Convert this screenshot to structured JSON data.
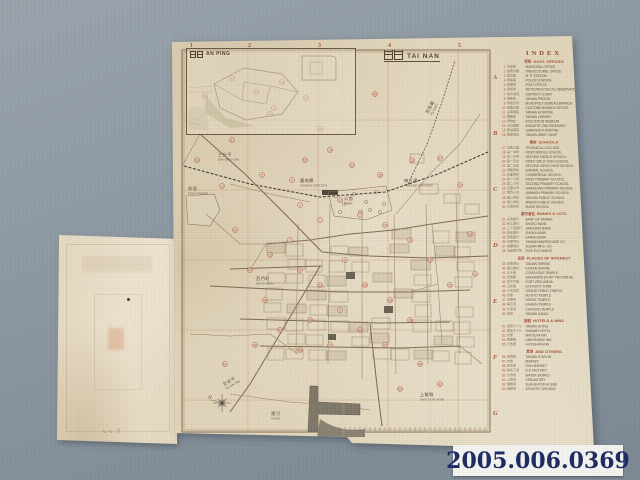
{
  "photo": {
    "backdrop_color": "#8c97a1",
    "paper_color": "#e7dcc4",
    "accent_red": "#b04f38",
    "ink_brown": "#5d4e3c",
    "label_navy": "#1d2a63"
  },
  "catalog": {
    "id": "2005.006.0369"
  },
  "flap": {
    "pencil_mark": "∿∿ 8"
  },
  "map": {
    "title_jp": "臺南",
    "title_en": "TAI NAN",
    "inset_jp": "安平",
    "inset_en": "AN PING",
    "compass": "N",
    "grid_cols": [
      "1",
      "2",
      "3",
      "4",
      "5"
    ],
    "grid_col_x": [
      20,
      78,
      148,
      218,
      288
    ],
    "grid_rows": [
      "A",
      "B",
      "C",
      "D",
      "E",
      "F",
      "G"
    ],
    "grid_row_y": [
      45,
      101,
      157,
      213,
      269,
      325,
      381
    ],
    "labels": [
      {
        "jp": "魚塭",
        "en": "FISH PONDS",
        "x": 18,
        "y": 156,
        "rot": 0
      },
      {
        "jp": "三分子",
        "en": "SAN BUN SHI",
        "x": 48,
        "y": 122,
        "rot": 0
      },
      {
        "jp": "臺南驛",
        "en": "TAINAN STATION",
        "x": 130,
        "y": 148,
        "rot": 0
      },
      {
        "jp": "公園",
        "en": "PARK",
        "x": 174,
        "y": 166,
        "rot": 0
      },
      {
        "jp": "練兵場",
        "en": "PARADE GROUND",
        "x": 234,
        "y": 148,
        "rot": 0
      },
      {
        "jp": "至嘉義",
        "en": "TO KAGI",
        "x": 258,
        "y": 80,
        "rot": -62
      },
      {
        "jp": "西門町",
        "en": "NISHI MON",
        "x": 86,
        "y": 246,
        "rot": 0
      },
      {
        "jp": "至安平",
        "en": "TO AN PEI",
        "x": 54,
        "y": 352,
        "rot": -30
      },
      {
        "jp": "運河",
        "en": "UNGA",
        "x": 101,
        "y": 381,
        "rot": 0
      },
      {
        "jp": "上鯤鯓",
        "en": "SHO KON SHIN",
        "x": 250,
        "y": 362,
        "rot": 0
      }
    ],
    "markers": [
      {
        "x": 62,
        "y": 44,
        "n": 43
      },
      {
        "x": 86,
        "y": 58,
        "n": 44
      },
      {
        "x": 112,
        "y": 48,
        "n": 45
      },
      {
        "x": 104,
        "y": 74,
        "n": 10
      },
      {
        "x": 136,
        "y": 64,
        "n": 52
      },
      {
        "x": 35,
        "y": 62,
        "n": 56
      },
      {
        "x": 62,
        "y": 106,
        "n": 31
      },
      {
        "x": 27,
        "y": 126,
        "n": 50
      },
      {
        "x": 52,
        "y": 152,
        "n": 12
      },
      {
        "x": 92,
        "y": 141,
        "n": 5
      },
      {
        "x": 122,
        "y": 146,
        "n": 3
      },
      {
        "x": 135,
        "y": 126,
        "n": 57
      },
      {
        "x": 160,
        "y": 116,
        "n": 14
      },
      {
        "x": 182,
        "y": 131,
        "n": 22
      },
      {
        "x": 210,
        "y": 141,
        "n": 18
      },
      {
        "x": 242,
        "y": 126,
        "n": 16
      },
      {
        "x": 270,
        "y": 124,
        "n": 37
      },
      {
        "x": 290,
        "y": 151,
        "n": 17
      },
      {
        "x": 130,
        "y": 171,
        "n": 4
      },
      {
        "x": 150,
        "y": 186,
        "n": 1
      },
      {
        "x": 170,
        "y": 166,
        "n": 13
      },
      {
        "x": 190,
        "y": 181,
        "n": 2
      },
      {
        "x": 215,
        "y": 191,
        "n": 24
      },
      {
        "x": 240,
        "y": 206,
        "n": 19
      },
      {
        "x": 260,
        "y": 226,
        "n": 25
      },
      {
        "x": 280,
        "y": 251,
        "n": 29
      },
      {
        "x": 120,
        "y": 206,
        "n": 7
      },
      {
        "x": 100,
        "y": 221,
        "n": 33
      },
      {
        "x": 80,
        "y": 236,
        "n": 41
      },
      {
        "x": 130,
        "y": 236,
        "n": 8
      },
      {
        "x": 150,
        "y": 251,
        "n": 32
      },
      {
        "x": 175,
        "y": 226,
        "n": 6
      },
      {
        "x": 195,
        "y": 251,
        "n": 34
      },
      {
        "x": 220,
        "y": 266,
        "n": 26
      },
      {
        "x": 170,
        "y": 276,
        "n": 9
      },
      {
        "x": 140,
        "y": 286,
        "n": 35
      },
      {
        "x": 110,
        "y": 296,
        "n": 42
      },
      {
        "x": 85,
        "y": 311,
        "n": 46
      },
      {
        "x": 130,
        "y": 316,
        "n": 58
      },
      {
        "x": 160,
        "y": 311,
        "n": 27
      },
      {
        "x": 190,
        "y": 296,
        "n": 38
      },
      {
        "x": 215,
        "y": 311,
        "n": 47
      },
      {
        "x": 240,
        "y": 286,
        "n": 28
      },
      {
        "x": 95,
        "y": 266,
        "n": 40
      },
      {
        "x": 65,
        "y": 196,
        "n": 51
      },
      {
        "x": 205,
        "y": 60,
        "n": 55
      },
      {
        "x": 150,
        "y": 95,
        "n": 23
      },
      {
        "x": 100,
        "y": 80,
        "n": 30
      },
      {
        "x": 250,
        "y": 330,
        "n": 48
      },
      {
        "x": 270,
        "y": 350,
        "n": 62
      },
      {
        "x": 300,
        "y": 200,
        "n": 20
      },
      {
        "x": 305,
        "y": 240,
        "n": 21
      },
      {
        "x": 55,
        "y": 330,
        "n": 61
      },
      {
        "x": 230,
        "y": 355,
        "n": 59
      }
    ]
  },
  "index": {
    "title": "INDEX",
    "sections": [
      {
        "jp": "官衙",
        "en": "GOVT. OFFICES",
        "rows": [
          {
            "n": 1,
            "jp": "市役所",
            "en": "MUNICIPAL OFFICE"
          },
          {
            "n": 2,
            "jp": "臺南州廳",
            "en": "PREFECTURAL OFFICE"
          },
          {
            "n": 3,
            "jp": "憲兵隊",
            "en": "M. P. STATION"
          },
          {
            "n": 4,
            "jp": "警察署",
            "en": "POLICE STATION"
          },
          {
            "n": 5,
            "jp": "郵便局",
            "en": "POST OFFICE"
          },
          {
            "n": 6,
            "jp": "測候所",
            "en": "METEOROLOGICAL OBSERVATORY"
          },
          {
            "n": 7,
            "jp": "地方法院",
            "en": "DISTRICT COURT"
          },
          {
            "n": 8,
            "jp": "刑務所",
            "en": "TAINAN PRISON"
          },
          {
            "n": 9,
            "jp": "專賣支局",
            "en": "MONOPOLY BUREAU BRANCH"
          },
          {
            "n": 10,
            "jp": "稅關支署",
            "en": "CUSTOMS BRANCH OFFICE"
          },
          {
            "n": 11,
            "jp": "臺南醫院",
            "en": "TAINAN HOSPITAL"
          },
          {
            "n": 12,
            "jp": "圖書館",
            "en": "TAINAN LIBRARY"
          },
          {
            "n": 13,
            "jp": "博物館",
            "en": "EDUCATION MUSEUM"
          },
          {
            "n": 14,
            "jp": "步兵聯隊",
            "en": "INFANTRY 2ND REGIMENT"
          },
          {
            "n": 15,
            "jp": "衛戍病院",
            "en": "GARRISON HOSPITAL"
          },
          {
            "n": 16,
            "jp": "陸軍墓地",
            "en": "TAINAN ARMY CAMP"
          }
        ]
      },
      {
        "jp": "學校",
        "en": "SCHOOLS",
        "rows": [
          {
            "n": 17,
            "jp": "高等工業",
            "en": "TECHNICAL COLLEGE"
          },
          {
            "n": 18,
            "jp": "第一中學",
            "en": "FIRST MIDDLE SCHOOL"
          },
          {
            "n": 19,
            "jp": "第二中學",
            "en": "SECOND MIDDLE SCHOOL"
          },
          {
            "n": 20,
            "jp": "第一高女",
            "en": "FIRST GIRLS' HIGH SCHOOL"
          },
          {
            "n": 21,
            "jp": "第二高女",
            "en": "SECOND GIRLS' HIGH SCHOOL"
          },
          {
            "n": 22,
            "jp": "師範學校",
            "en": "NORMAL SCHOOL"
          },
          {
            "n": 23,
            "jp": "商業學校",
            "en": "COMMERCIAL SCHOOL"
          },
          {
            "n": 24,
            "jp": "第一小學",
            "en": "FIRST PRIMARY SCHOOL"
          },
          {
            "n": 25,
            "jp": "第二小學",
            "en": "SECOND PRIMARY SCHOOL"
          },
          {
            "n": 26,
            "jp": "花園小學",
            "en": "HANAZONO PRIMARY SCHOOL"
          },
          {
            "n": 27,
            "jp": "南門小學",
            "en": "NANMON PRIMARY SCHOOL"
          },
          {
            "n": 28,
            "jp": "寶公學校",
            "en": "TAKARA PUBLIC SCHOOL"
          },
          {
            "n": 29,
            "jp": "港公學校",
            "en": "MINATO PUBLIC SCHOOL"
          },
          {
            "n": 30,
            "jp": "盲啞學校",
            "en": "BLIND SCHOOL"
          }
        ]
      },
      {
        "jp": "銀行會社",
        "en": "BANKS & CO'S.",
        "rows": [
          {
            "n": 31,
            "jp": "臺灣銀行",
            "en": "BANK OF TAIWAN"
          },
          {
            "n": 32,
            "jp": "商工銀行",
            "en": "SHOKO BANK"
          },
          {
            "n": 33,
            "jp": "三十四銀行",
            "en": "SANJUSHI BANK"
          },
          {
            "n": 34,
            "jp": "彰化銀行",
            "en": "SHOKA BANK"
          },
          {
            "n": 35,
            "jp": "華南銀行",
            "en": "KANAN BANK"
          },
          {
            "n": 36,
            "jp": "倉庫會社",
            "en": "TAIWAN WAREHOUSE CO."
          },
          {
            "n": 37,
            "jp": "製糖會社",
            "en": "SUGAR MFG. CO."
          },
          {
            "n": 38,
            "jp": "米穀取引所",
            "en": "RICE EXCHANGE"
          }
        ]
      },
      {
        "jp": "名所",
        "en": "PLACES OF INTEREST",
        "rows": [
          {
            "n": 39,
            "jp": "臺南神社",
            "en": "TAINAN SHRINE"
          },
          {
            "n": 40,
            "jp": "開山神社",
            "en": "KAIZAN SHRINE"
          },
          {
            "n": 41,
            "jp": "孔子廟",
            "en": "CONFUCIUS TEMPLE"
          },
          {
            "n": 42,
            "jp": "赤嵌樓",
            "en": "SEKKANRO (FORT PROVINTIA)"
          },
          {
            "n": 43,
            "jp": "安平古堡",
            "en": "FORT ZEELANDIA"
          },
          {
            "n": 44,
            "jp": "五妃廟",
            "en": "GOHI BYO TOMB"
          },
          {
            "n": 45,
            "jp": "大天后宮",
            "en": "GRAND TENKO TEMPLE"
          },
          {
            "n": 46,
            "jp": "武廟",
            "en": "BU BYO TEMPLE"
          },
          {
            "n": 47,
            "jp": "法華寺",
            "en": "HOKKE TEMPLE"
          },
          {
            "n": 48,
            "jp": "開元寺",
            "en": "KAIGEN TEMPLE"
          },
          {
            "n": 49,
            "jp": "竹溪寺",
            "en": "CHIKUKEI TEMPLE"
          },
          {
            "n": 50,
            "jp": "運河",
            "en": "TAINAN CANAL"
          }
        ]
      },
      {
        "jp": "旅館",
        "en": "HOTELS & INNS",
        "rows": [
          {
            "n": 51,
            "jp": "臺南ホテル",
            "en": "TAINAN HOTEL"
          },
          {
            "n": 52,
            "jp": "鐵道ホテル",
            "en": "RAILWAY HOTEL"
          },
          {
            "n": 53,
            "jp": "松屋",
            "en": "MATSUYA INN"
          },
          {
            "n": 54,
            "jp": "梅屋敷",
            "en": "UMEYASHIKI INN"
          },
          {
            "n": 55,
            "jp": "日吉屋",
            "en": "HIYOSHIYA INN"
          }
        ]
      },
      {
        "jp": "其他",
        "en": "AND OTHERS",
        "rows": [
          {
            "n": 56,
            "jp": "臺南驛",
            "en": "TAINAN STATION"
          },
          {
            "n": 57,
            "jp": "市場",
            "en": "MARKET"
          },
          {
            "n": 58,
            "jp": "魚市場",
            "en": "FISH MARKET"
          },
          {
            "n": 59,
            "jp": "製冰工場",
            "en": "ICE FACTORY"
          },
          {
            "n": 60,
            "jp": "水源地",
            "en": "WATER WORKS"
          },
          {
            "n": 61,
            "jp": "火葬場",
            "en": "CREMATORY"
          },
          {
            "n": 62,
            "jp": "屠獸場",
            "en": "SLAUGHTER HOUSE"
          },
          {
            "n": 63,
            "jp": "運動場",
            "en": "ATHLETIC GROUND"
          }
        ]
      }
    ]
  }
}
